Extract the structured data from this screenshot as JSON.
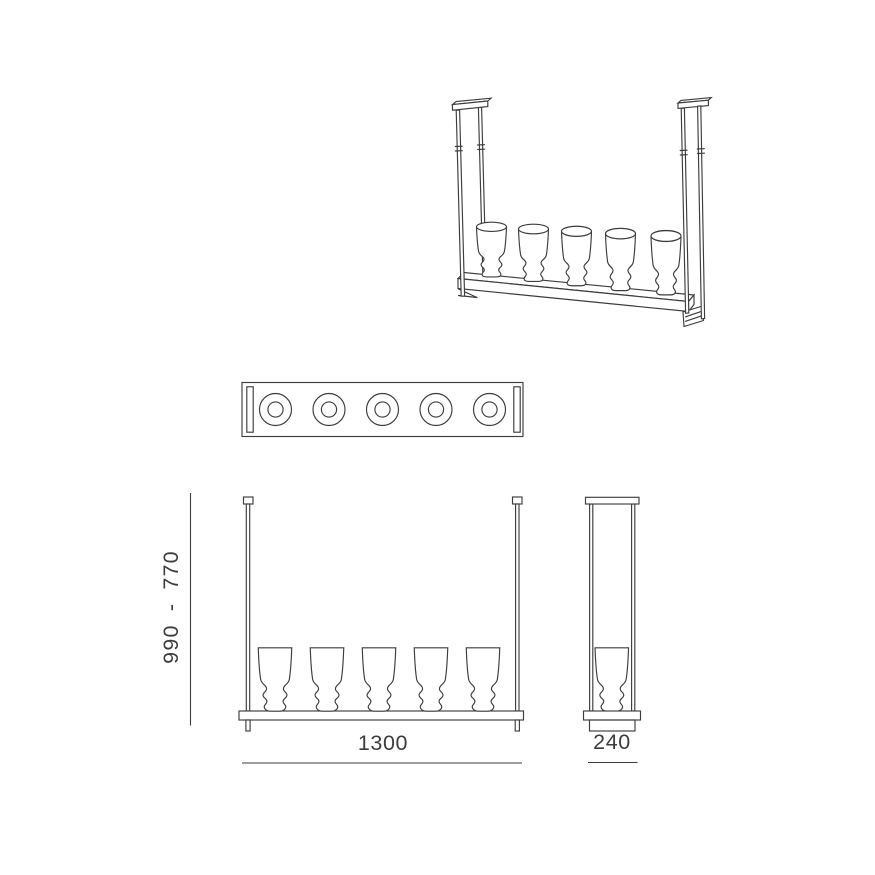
{
  "drawing": {
    "background": "#ffffff",
    "line_color": "#3d3d3d",
    "text_color": "#3c3c3c",
    "glass_count": 5,
    "dimensions": {
      "height_range": "990 - 770",
      "width": "1300",
      "depth": "240"
    }
  }
}
